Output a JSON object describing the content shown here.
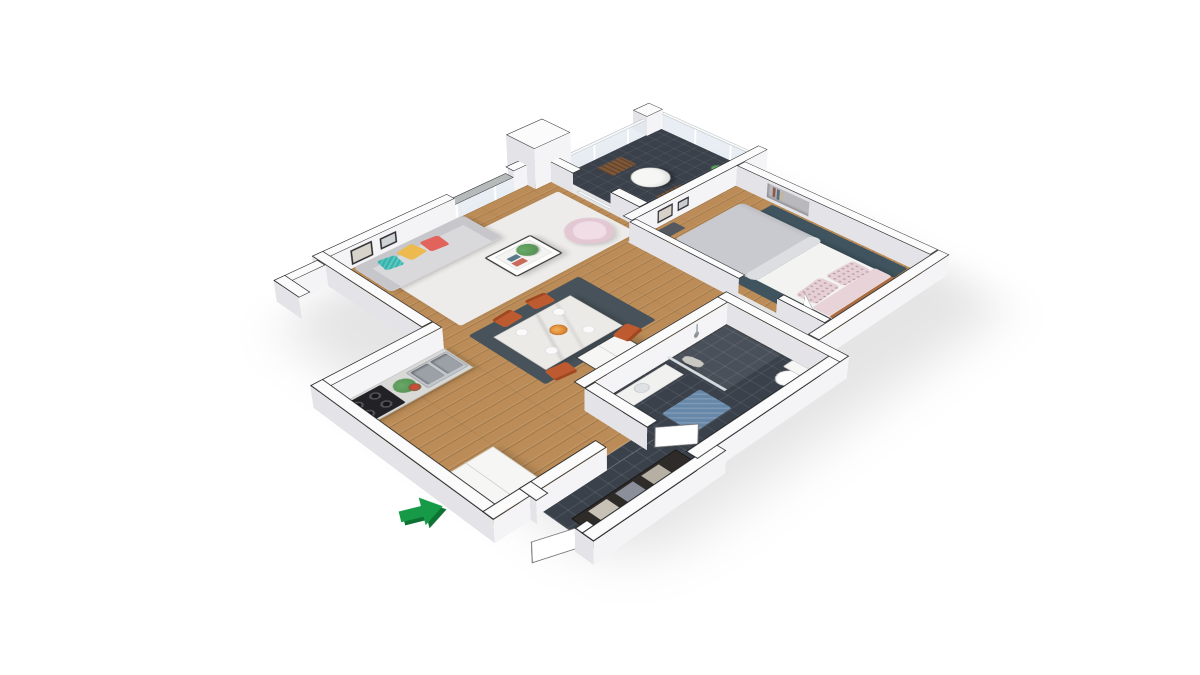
{
  "scene": {
    "label": "3D isometric apartment floor plan render",
    "view": "isometric-top-down",
    "entrance": {
      "icon": "entrance-arrow-icon",
      "points_to": "entry-door"
    },
    "rooms": [
      {
        "id": "living-room",
        "floor": "wood",
        "items": [
          "sofa",
          "pillow-teal",
          "pillow-yellow",
          "pillow-red",
          "coffee-table",
          "potted-plant",
          "armchair",
          "wall-art",
          "area-rug"
        ]
      },
      {
        "id": "balcony",
        "floor": "dark-tile",
        "items": [
          "round-table",
          "wood-chair",
          "wood-chair",
          "plant",
          "glass-railing"
        ]
      },
      {
        "id": "kitchen",
        "floor": "wood",
        "items": [
          "counter",
          "stove",
          "double-sink",
          "plant",
          "cabinet"
        ]
      },
      {
        "id": "dining-area",
        "floor": "wood",
        "items": [
          "marble-table",
          "chair-rust",
          "chair-rust",
          "chair-rust",
          "chair-rust",
          "plates",
          "fruit-bowl",
          "dark-rug",
          "tall-cupboard"
        ]
      },
      {
        "id": "bedroom",
        "floor": "wood",
        "items": [
          "double-bed",
          "duvet",
          "pillow-pink",
          "pillow-pink",
          "headboard",
          "teal-rug",
          "wall-art",
          "niche-shelf",
          "open-door"
        ]
      },
      {
        "id": "bathroom",
        "floor": "dark-tile",
        "items": [
          "vanity",
          "shower-glass",
          "shower-head",
          "toilet",
          "blue-mat",
          "robes"
        ]
      },
      {
        "id": "hallway",
        "floor": "dark-tile",
        "items": [
          "wardrobe",
          "entry-door",
          "coat"
        ]
      }
    ]
  },
  "colors": {
    "bg": "#ffffff",
    "wallTop": "#fbfbfb",
    "wallLine": "#1a1b1d",
    "faceLight": "#f4f4f6",
    "faceShade": "#e3e3e8",
    "sill": "#b6baba",
    "woodFloor": "#bb8c57",
    "tileDark": "#3a414b",
    "rugLiving": "#edecea",
    "rugDining": "#47525a",
    "rugBedroom": "#3f545f",
    "matBlue": "#6787a8",
    "sofa": "#d9d9dc",
    "sofaDark": "#c6c6cb",
    "pillowTeal": "#35b5ad",
    "pillowYellow": "#ecba4e",
    "pillowRed": "#e2635c",
    "armchair": "#e3c8d4",
    "chairRust": "#bd5a30",
    "tableMarble": "#eceae7",
    "cupboard": "#f6f6f4",
    "counter": "#d9dad7",
    "steel": "#9ba1a7",
    "stove": "#222226",
    "duvet": "#c9cacf",
    "sheet": "#f3f3f1",
    "pillowPink": "#e6d0d6",
    "headboard": "#aa6c42",
    "balconyChair": "#7d5738",
    "plantGreen": "#4e8b4c",
    "wardrobe": "#2e2b29",
    "arrowGreen": "#169a47",
    "arrowShadow": "#0d7233",
    "door": "#ffffff"
  }
}
